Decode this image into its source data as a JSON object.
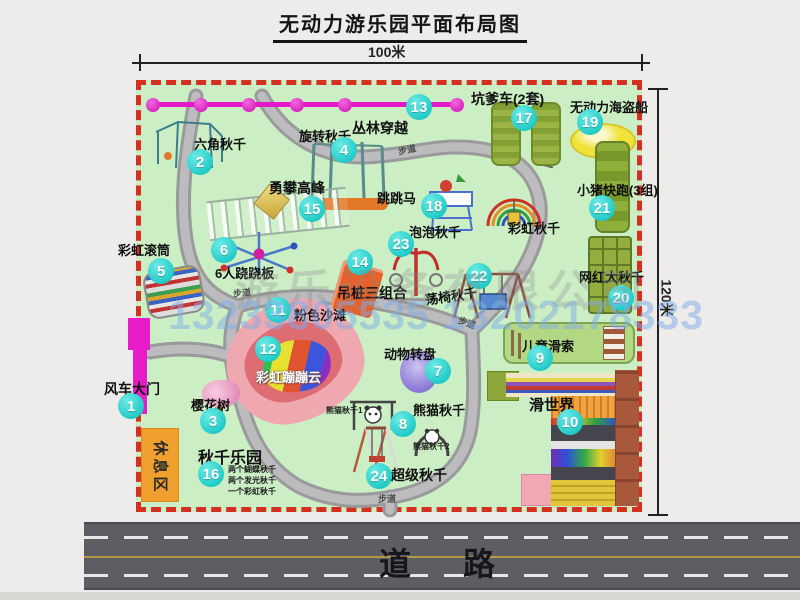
{
  "title": "无动力游乐园平面布局图",
  "dim_top": "100米",
  "dim_right": "120米",
  "road_label": "道　路",
  "rest_area_label": "休息区",
  "watermark": {
    "company": "游乐设备有限公司",
    "phone": "13233805535 13202178333"
  },
  "colors": {
    "map_bg": "#cbeec4",
    "border_red": "#d43020",
    "badge_cyan": "#23ccc8",
    "zipline_magenta": "#e318c8",
    "road_gray": "#5d5d64"
  },
  "attractions": [
    {
      "num": "1",
      "name": "风车大门",
      "bx": 131,
      "by": 406,
      "lx": 104,
      "ly": 379,
      "fs": 14
    },
    {
      "num": "2",
      "name": "六角秋千",
      "bx": 200,
      "by": 162,
      "lx": 194,
      "ly": 134,
      "fs": 13
    },
    {
      "num": "3",
      "name": "樱花树",
      "bx": 213,
      "by": 421,
      "lx": 191,
      "ly": 395,
      "fs": 13
    },
    {
      "num": "4",
      "name": "旋转秋千",
      "bx": 344,
      "by": 150,
      "lx": 299,
      "ly": 126,
      "fs": 13
    },
    {
      "num": "5",
      "name": "彩虹滚筒",
      "bx": 161,
      "by": 271,
      "lx": 118,
      "ly": 240,
      "fs": 13
    },
    {
      "num": "6",
      "name": "6人跷跷板",
      "bx": 224,
      "by": 250,
      "lx": 215,
      "ly": 263,
      "fs": 13
    },
    {
      "num": "7",
      "name": "动物转盘",
      "bx": 438,
      "by": 371,
      "lx": 384,
      "ly": 344,
      "fs": 13
    },
    {
      "num": "8",
      "name": "熊猫秋千",
      "bx": 403,
      "by": 424,
      "lx": 413,
      "ly": 400,
      "fs": 13
    },
    {
      "num": "9",
      "name": "儿童滑索",
      "bx": 540,
      "by": 358,
      "lx": 522,
      "ly": 336,
      "fs": 13
    },
    {
      "num": "10",
      "name": "滑世界",
      "bx": 570,
      "by": 422,
      "lx": 529,
      "ly": 394,
      "fs": 15
    },
    {
      "num": "11",
      "name": "粉色沙滩",
      "bx": 278,
      "by": 310,
      "lx": 294,
      "ly": 305,
      "fs": 13
    },
    {
      "num": "12",
      "name": "彩虹蹦蹦云",
      "bx": 268,
      "by": 349,
      "lx": 256,
      "ly": 367,
      "fs": 13,
      "light": true
    },
    {
      "num": "13",
      "name": "丛林穿越",
      "bx": 419,
      "by": 107,
      "lx": 352,
      "ly": 118,
      "fs": 14
    },
    {
      "num": "14",
      "name": "吊桩三组合",
      "bx": 360,
      "by": 262,
      "lx": 337,
      "ly": 283,
      "fs": 14
    },
    {
      "num": "15",
      "name": "勇攀高峰",
      "bx": 312,
      "by": 209,
      "lx": 269,
      "ly": 178,
      "fs": 14
    },
    {
      "num": "16",
      "name": "秋千乐园",
      "bx": 211,
      "by": 474,
      "lx": 198,
      "ly": 444,
      "fs": 16
    },
    {
      "num": "17",
      "name": "坑爹车(2套)",
      "bx": 524,
      "by": 118,
      "lx": 471,
      "ly": 89,
      "fs": 14
    },
    {
      "num": "18",
      "name": "跳跳马",
      "bx": 434,
      "by": 206,
      "lx": 377,
      "ly": 188,
      "fs": 13
    },
    {
      "num": "19",
      "name": "无动力海盗船",
      "bx": 590,
      "by": 122,
      "lx": 570,
      "ly": 97,
      "fs": 13
    },
    {
      "num": "20",
      "name": "网红大秋千",
      "bx": 621,
      "by": 298,
      "lx": 579,
      "ly": 267,
      "fs": 13
    },
    {
      "num": "21",
      "name": "小猪快跑(3组)",
      "bx": 602,
      "by": 208,
      "lx": 577,
      "ly": 180,
      "fs": 13
    },
    {
      "num": "22",
      "name": "荡椅秋千",
      "bx": 479,
      "by": 276,
      "lx": 425,
      "ly": 286,
      "fs": 13,
      "rot": -8
    },
    {
      "num": "23",
      "name": "泡泡秋千",
      "bx": 401,
      "by": 244,
      "lx": 409,
      "ly": 222,
      "fs": 13
    },
    {
      "num": "24",
      "name": "超级秋千",
      "bx": 379,
      "by": 476,
      "lx": 391,
      "ly": 465,
      "fs": 14
    },
    {
      "num": "",
      "name": "彩虹秋千",
      "bx": 0,
      "by": 0,
      "lx": 508,
      "ly": 218,
      "fs": 13
    }
  ],
  "path_labels": [
    {
      "text": "步道",
      "x": 398,
      "y": 143,
      "r": -12
    },
    {
      "text": "步道",
      "x": 536,
      "y": 156,
      "r": 10
    },
    {
      "text": "步道",
      "x": 233,
      "y": 286,
      "r": -6
    },
    {
      "text": "步道",
      "x": 458,
      "y": 316,
      "r": 20
    },
    {
      "text": "步道",
      "x": 248,
      "y": 400,
      "r": 72
    },
    {
      "text": "步道",
      "x": 378,
      "y": 492,
      "r": 0
    }
  ],
  "mini_labels": [
    {
      "text": "熊猫秋千1",
      "x": 326,
      "y": 405
    },
    {
      "text": "熊猫秋千2",
      "x": 413,
      "y": 441
    }
  ],
  "swing_notes": [
    "两个蝴蝶秋千",
    "两个发光秋千",
    "一个彩虹秋千"
  ]
}
